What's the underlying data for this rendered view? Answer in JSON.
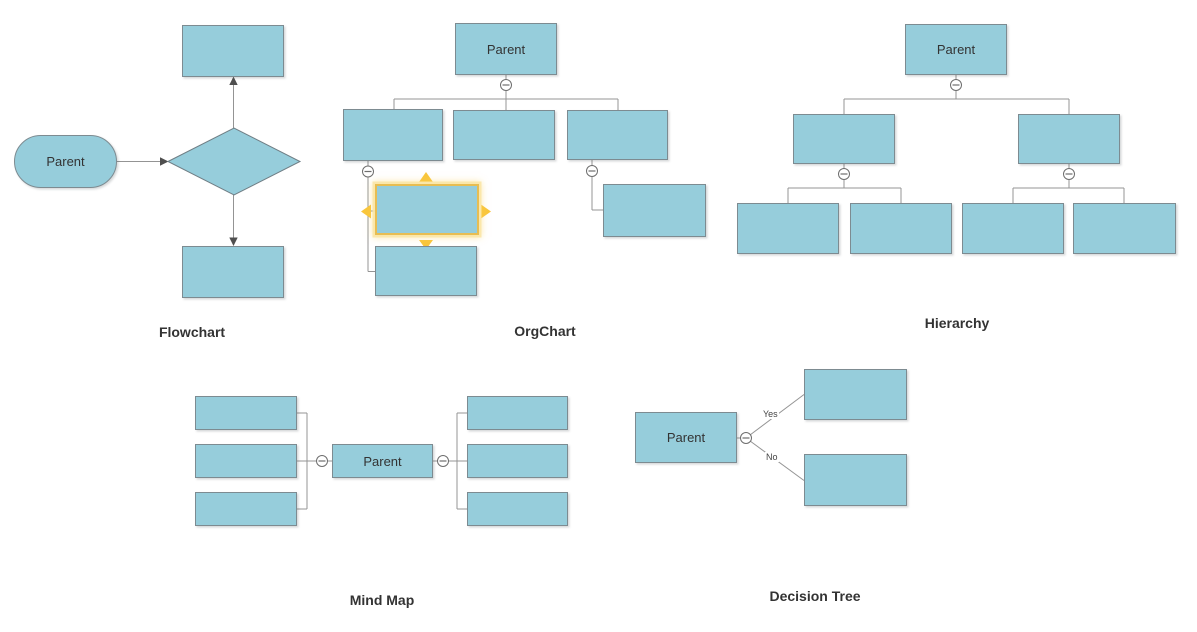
{
  "colors": {
    "canvas_background": "#ffffff",
    "node_fill": "#96cddb",
    "node_stroke": "#7d8b91",
    "connector": "#949494",
    "arrowhead": "#4f4f4f",
    "selection_border": "#e7bd52",
    "selection_arrow": "#f9c63c",
    "text": "#333333"
  },
  "icons": {
    "collapse": "⊖"
  },
  "diagrams": {
    "flowchart": {
      "caption": "Flowchart",
      "start_node_label": "Parent"
    },
    "orgchart": {
      "caption": "OrgChart",
      "root_label": "Parent"
    },
    "hierarchy": {
      "caption": "Hierarchy",
      "root_label": "Parent"
    },
    "mindmap": {
      "caption": "Mind Map",
      "root_label": "Parent"
    },
    "decision_tree": {
      "caption": "Decision Tree",
      "root_label": "Parent",
      "branch_labels": {
        "yes": "Yes",
        "no": "No"
      }
    }
  }
}
